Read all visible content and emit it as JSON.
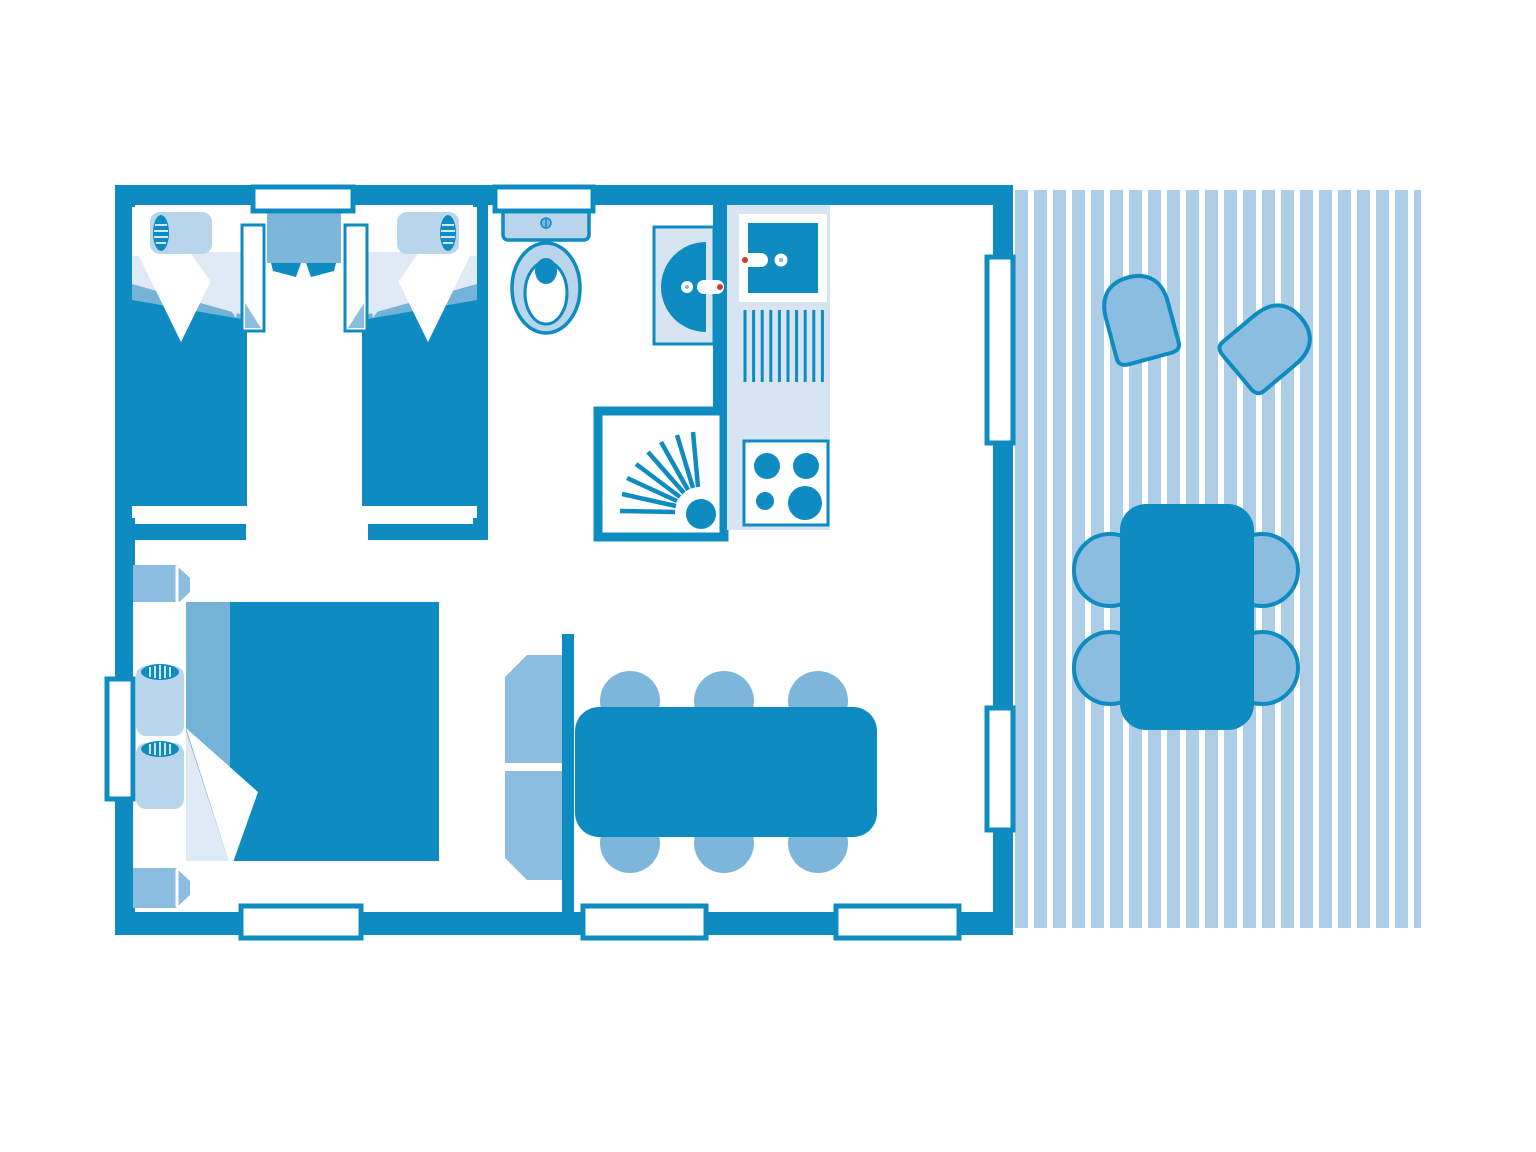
{
  "meta": {
    "title": "Mobile-home floor plan",
    "description": "Top-down floor plan of a two-bedroom holiday mobile home with bathroom, kitchenette, living-dining area and a slatted wooden terrace",
    "canvas": {
      "width": 1536,
      "height": 1152
    }
  },
  "palette": {
    "primary": "#0e8cc2",
    "mid": "#7cb7db",
    "unit": "#8abddf",
    "light": "#b9d5ec",
    "counter": "#d7e5f3",
    "sheet": "#dfeaf6",
    "fold": "#74b2d8",
    "deck": "#aecde6",
    "accent": "#d5392c",
    "paper": "#ffffff"
  },
  "structure": {
    "rooms": [
      {
        "id": "bedroom-twin",
        "label": "twin bedroom",
        "furniture": [
          "single-bed-left",
          "single-bed-right",
          "nightstand",
          "side-unit-left",
          "side-unit-right"
        ]
      },
      {
        "id": "bathroom",
        "label": "bathroom",
        "furniture": [
          "toilet",
          "washbasin",
          "shower"
        ]
      },
      {
        "id": "kitchen",
        "label": "kitchenette",
        "furniture": [
          "sink",
          "drainer",
          "hob"
        ]
      },
      {
        "id": "bedroom-double",
        "label": "double bedroom",
        "furniture": [
          "double-bed",
          "bedside-table-top",
          "bedside-table-bottom",
          "wardrobe"
        ]
      },
      {
        "id": "living-dining",
        "label": "living / dining",
        "furniture": [
          "dining-table",
          "dining-chairs-x6"
        ]
      },
      {
        "id": "terrace",
        "label": "terrace deck",
        "furniture": [
          "outdoor-table",
          "stools-x4",
          "deck-chairs-x2"
        ]
      }
    ],
    "openings": {
      "windows": [
        "top-window-bedroom",
        "top-window-bathroom",
        "left-window-bedroom",
        "right-window-terrace",
        "bottom-window-bedroom",
        "bottom-window-living",
        "bottom-window-living-2"
      ],
      "doors": [
        "terrace-door",
        "twin-bedroom-doorway",
        "double-bedroom-doorway",
        "bathroom-doorway"
      ]
    }
  }
}
